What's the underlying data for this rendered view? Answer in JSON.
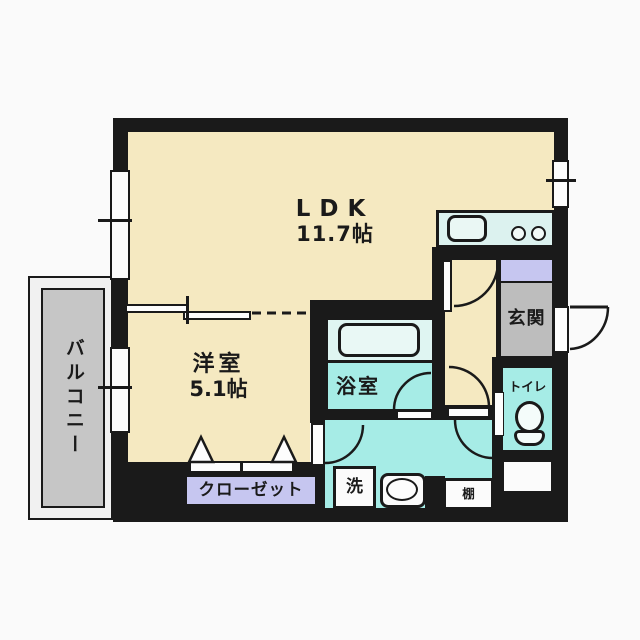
{
  "type": "apartment-floorplan",
  "rooms": {
    "ldk": {
      "label": "LDK",
      "size": "11.7帖"
    },
    "western": {
      "label": "洋室",
      "size": "5.1帖"
    },
    "balcony": {
      "label": "バルコニー"
    },
    "entrance": {
      "label": "玄関"
    },
    "bathroom": {
      "label": "浴室"
    },
    "toilet": {
      "label": "トイレ"
    },
    "closet": {
      "label": "クローゼット"
    },
    "laundry": {
      "label": "洗"
    },
    "shelf": {
      "label": "棚"
    }
  },
  "colors": {
    "background": "#FAFAFA",
    "wall": "#1A1A1A",
    "room_floor": "#F5E9C1",
    "wet_floor": "#A6ECE6",
    "bathtub_zone": "#DFF5F2",
    "kitchen_counter": "#DCF2EF",
    "entrance_floor": "#BDBDBD",
    "storage_lavender": "#C6C6F0",
    "balcony_floor": "#C6C6C6",
    "fixture_white": "#FBFBFB"
  }
}
